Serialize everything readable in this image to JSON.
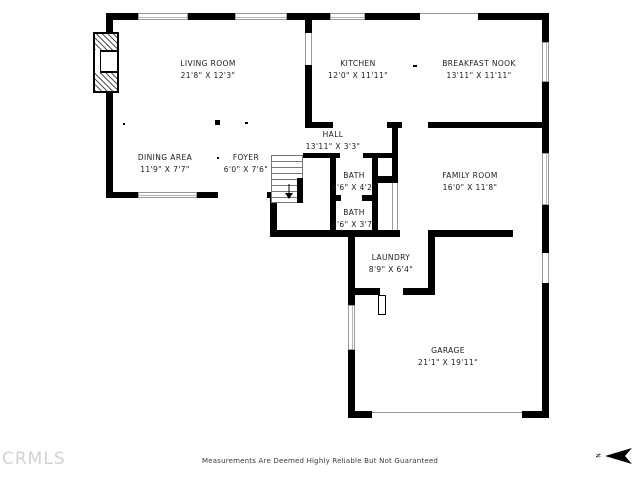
{
  "page": {
    "background": "#ffffff",
    "wall_color": "#000000",
    "text_color": "#1b1b1b"
  },
  "rooms": {
    "living_room": {
      "label": "LIVING ROOM",
      "dims": "21'8\" X 12'3\""
    },
    "kitchen": {
      "label": "KITCHEN",
      "dims": "12'0\" X 11'11\""
    },
    "breakfast_nook": {
      "label": "BREAKFAST NOOK",
      "dims": "13'11\" X 11'11\""
    },
    "dining_area": {
      "label": "DINING AREA",
      "dims": "11'9\" X 7'7\""
    },
    "foyer": {
      "label": "FOYER",
      "dims": "6'0\" X 7'6\""
    },
    "hall": {
      "label": "HALL",
      "dims": "13'11\" X 3'3\""
    },
    "bath_upper": {
      "label": "BATH",
      "dims": "4'6\" X 4'2\""
    },
    "bath_lower": {
      "label": "BATH",
      "dims": "4'6\" X 3'7\""
    },
    "family_room": {
      "label": "FAMILY ROOM",
      "dims": "16'0\" X 11'8\""
    },
    "laundry": {
      "label": "LAUNDRY",
      "dims": "8'9\" X 6'4\""
    },
    "garage": {
      "label": "GARAGE",
      "dims": "21'1\" X 19'11\""
    }
  },
  "footer": {
    "disclaimer": "Measurements Are Deemed Highly Reliable But Not Guaranteed",
    "watermark": "CRMLS"
  },
  "compass": {
    "letter": "N"
  }
}
